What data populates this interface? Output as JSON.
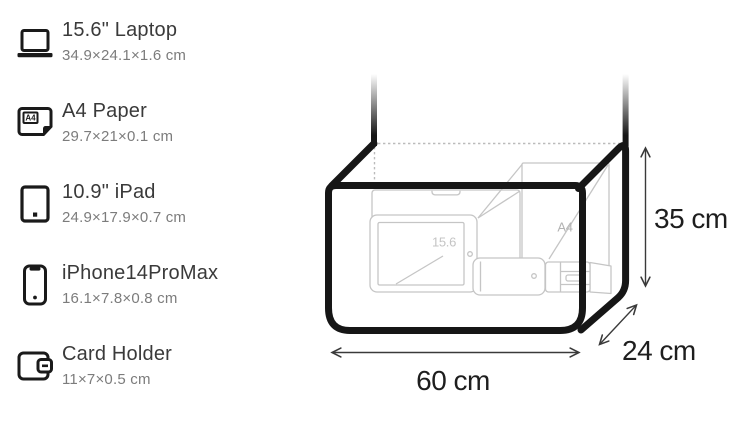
{
  "items": [
    {
      "title": "15.6\" Laptop",
      "dims": "34.9×24.1×1.6 cm"
    },
    {
      "title": "A4 Paper",
      "dims": "29.7×21×0.1 cm"
    },
    {
      "title": "10.9\" iPad",
      "dims": "24.9×17.9×0.7 cm"
    },
    {
      "title": "iPhone14ProMax",
      "dims": "16.1×7.8×0.8 cm"
    },
    {
      "title": "Card Holder",
      "dims": "11×7×0.5 cm"
    }
  ],
  "icons": {
    "a4_label": "A4"
  },
  "bag": {
    "height_label": "35 cm",
    "depth_label": "24 cm",
    "width_label": "60 cm",
    "laptop_tag": "15.6",
    "paper_tag": "A4"
  },
  "colors": {
    "bag_outline": "#161616",
    "item_outline": "#c5c5c5",
    "dotted_edge": "#bbbbbb",
    "dimension_text": "#1e1e1e",
    "title_text": "#3a3a3a",
    "subtitle_text": "#7c7c7c",
    "background": "#ffffff"
  }
}
